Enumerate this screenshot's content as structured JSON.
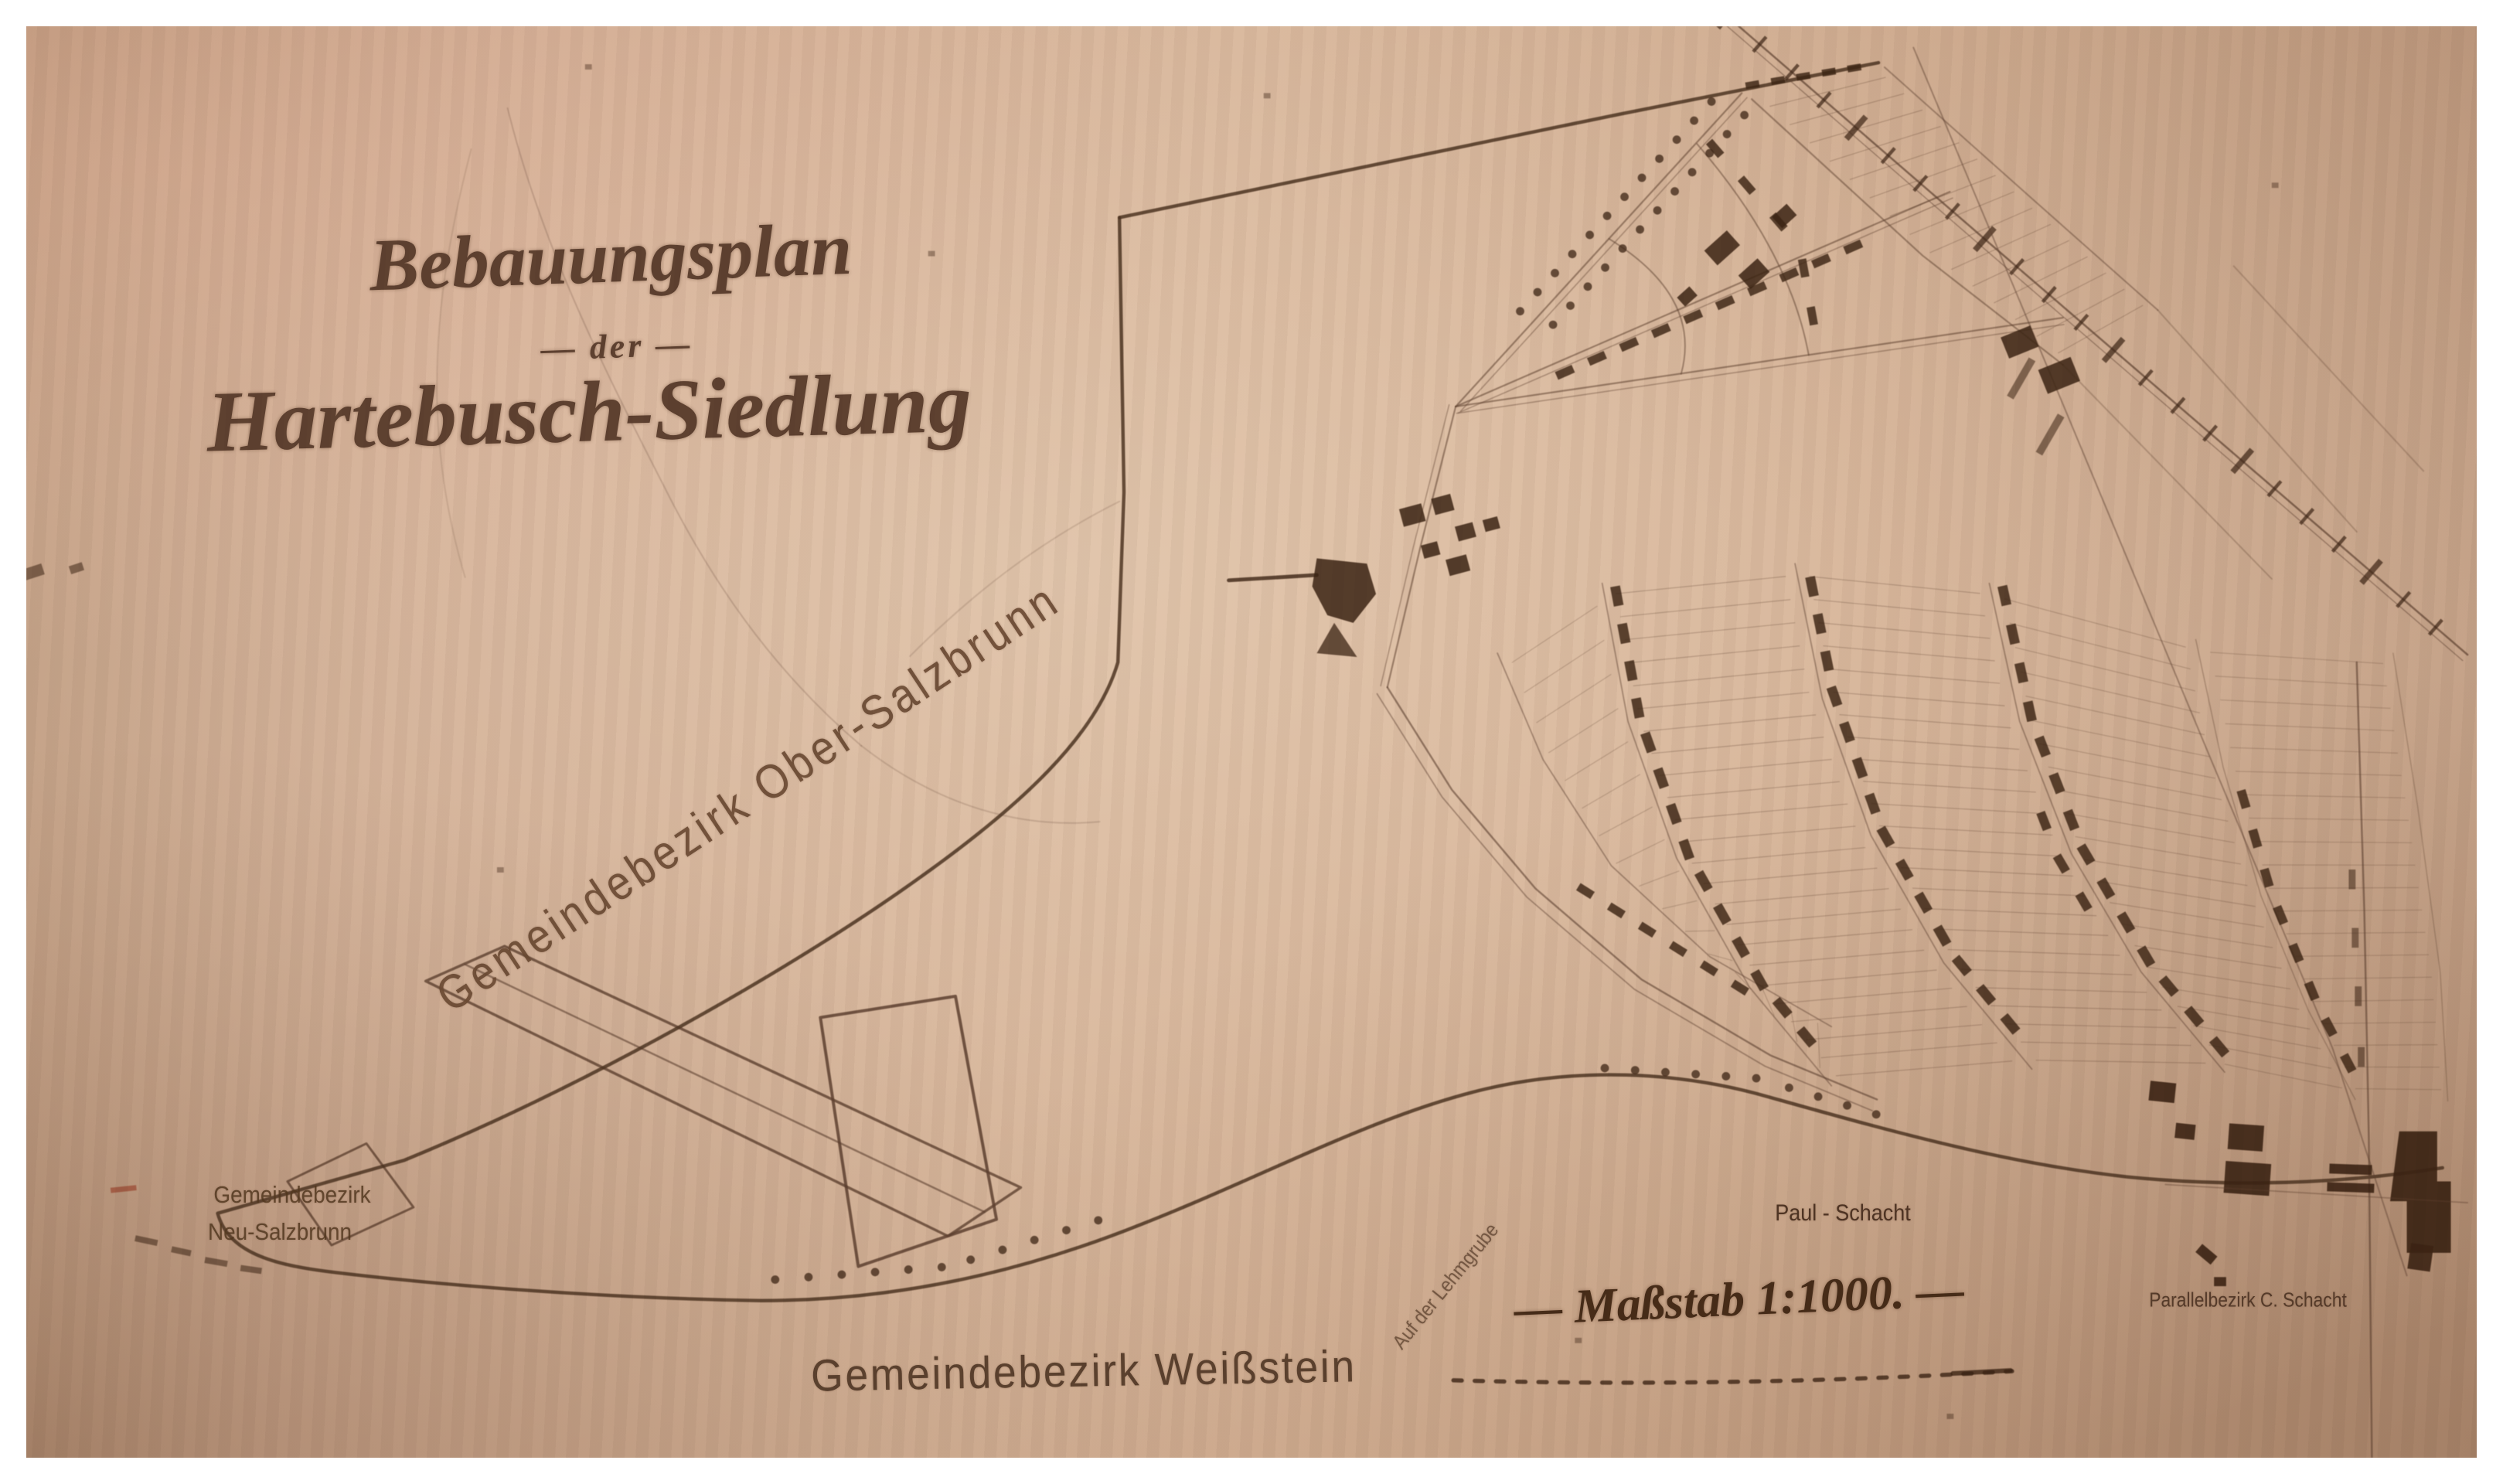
{
  "title": {
    "line1": "Bebauungsplan",
    "line2": "— der —",
    "line3": "Hartebusch-Siedlung"
  },
  "districts": {
    "ober_salzbrunn": "Gemeindebezirk Ober-Salzbrunn",
    "neu_salzbrunn_line1": "Gemeindebezirk",
    "neu_salzbrunn_line2": "Neu-Salzbrunn",
    "weissstein": "Gemeindebezirk Weißstein"
  },
  "labels": {
    "scale": "— Maßstab 1:1000. —",
    "paul_schacht": "Paul - Schacht",
    "parallelbezirk": "Parallelbezirk C. Schacht",
    "street": "Auf der Lehmgrube"
  },
  "colors": {
    "paper": "#c9a288",
    "ink": "#5e4130",
    "ink_dark": "#3c2414",
    "boundary": "#4e3522",
    "red_mark": "#9c4f38"
  }
}
